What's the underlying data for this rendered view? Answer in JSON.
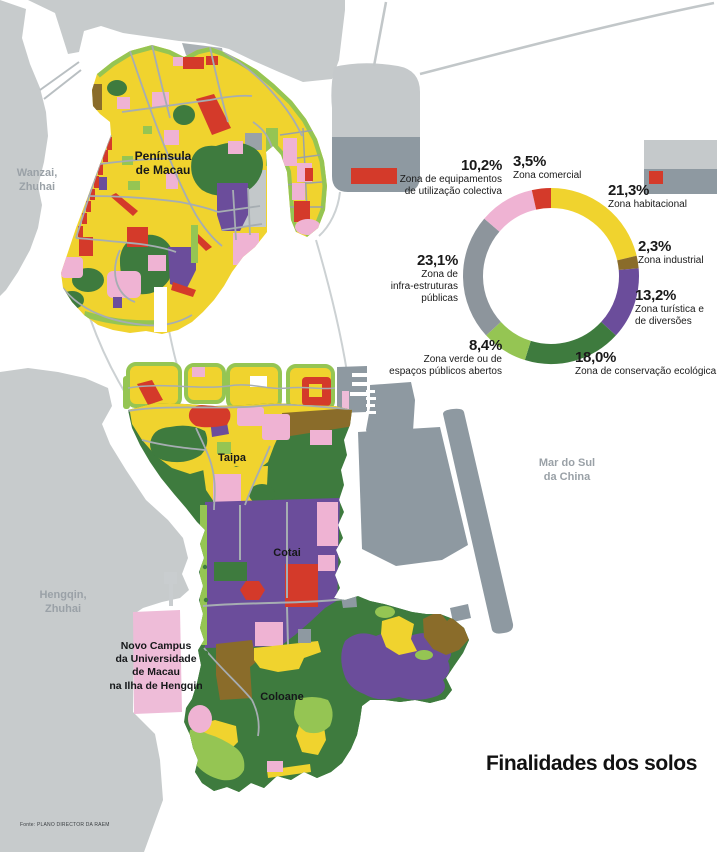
{
  "title": "Finalidades dos solos",
  "source": "Fonte: PLANO DIRECTOR DA RAEM",
  "map_labels": {
    "wanzai_1": "Wanzai,",
    "wanzai_2": "Zhuhai",
    "peninsula_1": "Península",
    "peninsula_2": "de Macau",
    "taipa": "Taipa",
    "cotai": "Cotai",
    "coloane": "Coloane",
    "hengqin_1": "Hengqin,",
    "hengqin_2": "Zhuhai",
    "sea_1": "Mar do Sul",
    "sea_2": "da China",
    "campus_1": "Novo Campus",
    "campus_2": "da Universidade",
    "campus_3": "de Macau",
    "campus_4": "na Ilha de Hengqin"
  },
  "colors": {
    "background": "#ffffff",
    "foreign_land": "#c7cbcc",
    "infrastructure_gray": "#8e99a1",
    "label_gray": "#9aa1a7",
    "text_black": "#16181a"
  },
  "chart_data": {
    "type": "pie",
    "donut": true,
    "title": "Finalidades dos solos",
    "legend_position": "around",
    "units": "%",
    "segments": [
      {
        "name": "Zona habitacional",
        "pct_label": "21,3%",
        "value": 21.3,
        "color": "#f0d32e",
        "lines": [
          "Zona habitacional"
        ]
      },
      {
        "name": "Zona industrial",
        "pct_label": "2,3%",
        "value": 2.3,
        "color": "#8a6c2a",
        "lines": [
          "Zona industrial"
        ]
      },
      {
        "name": "Zona turística e de diversões",
        "pct_label": "13,2%",
        "value": 13.2,
        "color": "#6b4d9b",
        "lines": [
          "Zona turística e",
          "de diversões"
        ]
      },
      {
        "name": "Zona de conservação ecológica",
        "pct_label": "18,0%",
        "value": 18.0,
        "color": "#3e7b3e",
        "lines": [
          "Zona de conservação ecológica"
        ]
      },
      {
        "name": "Zona verde ou de espaços públicos abertos",
        "pct_label": "8,4%",
        "value": 8.4,
        "color": "#95c553",
        "lines": [
          "Zona verde ou de",
          "espaços públicos abertos"
        ]
      },
      {
        "name": "Zona de infra-estruturas públicas",
        "pct_label": "23,1%",
        "value": 23.1,
        "color": "#8d959c",
        "lines": [
          "Zona de",
          "infra-estruturas",
          "públicas"
        ]
      },
      {
        "name": "Zona de equipamentos de utilização colectiva",
        "pct_label": "10,2%",
        "value": 10.2,
        "color": "#efb3d3",
        "lines": [
          "Zona de equipamentos",
          "de utilização colectiva"
        ]
      },
      {
        "name": "Zona comercial",
        "pct_label": "3,5%",
        "value": 3.5,
        "color": "#d43a2a",
        "lines": [
          "Zona comercial"
        ]
      }
    ]
  }
}
